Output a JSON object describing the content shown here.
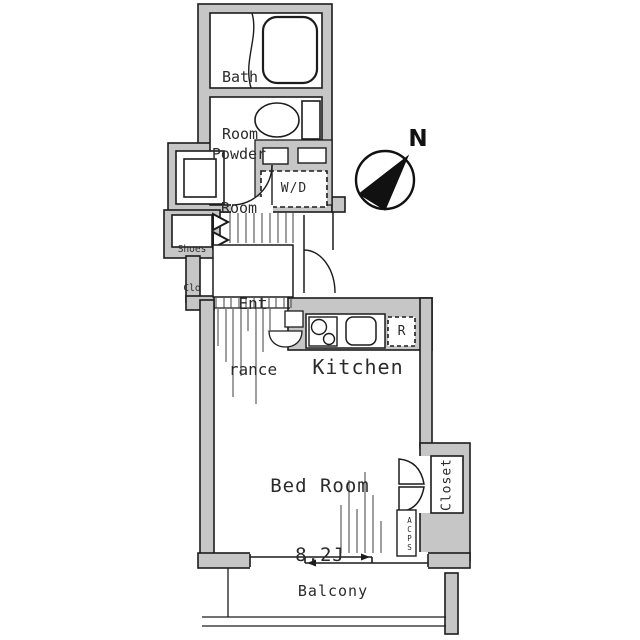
{
  "meta": {
    "type": "apartment floor plan"
  },
  "colors": {
    "background": "#ffffff",
    "wall_fill": "#c6c6c6",
    "line": "#1c1c1c",
    "hatch": "#3f3f3f",
    "text": "#2b2b2b",
    "compass": "#111111"
  },
  "labels": {
    "bath": {
      "line1": "Bath",
      "line2": "Room"
    },
    "powder": {
      "line1": "Powder",
      "line2": "Room"
    },
    "washer_dryer": "W/D",
    "shoes_closet": {
      "line1": "Shoes",
      "line2": "Clo"
    },
    "entrance": {
      "line1": "Ent",
      "line2": "rance"
    },
    "kitchen": "Kitchen",
    "refrigerator": "R",
    "bedroom": {
      "line1": "Bed Room",
      "line2": "8.2J"
    },
    "closet": "Closet",
    "acps": "ACPS",
    "balcony": "Balcony",
    "compass_north": "N"
  }
}
